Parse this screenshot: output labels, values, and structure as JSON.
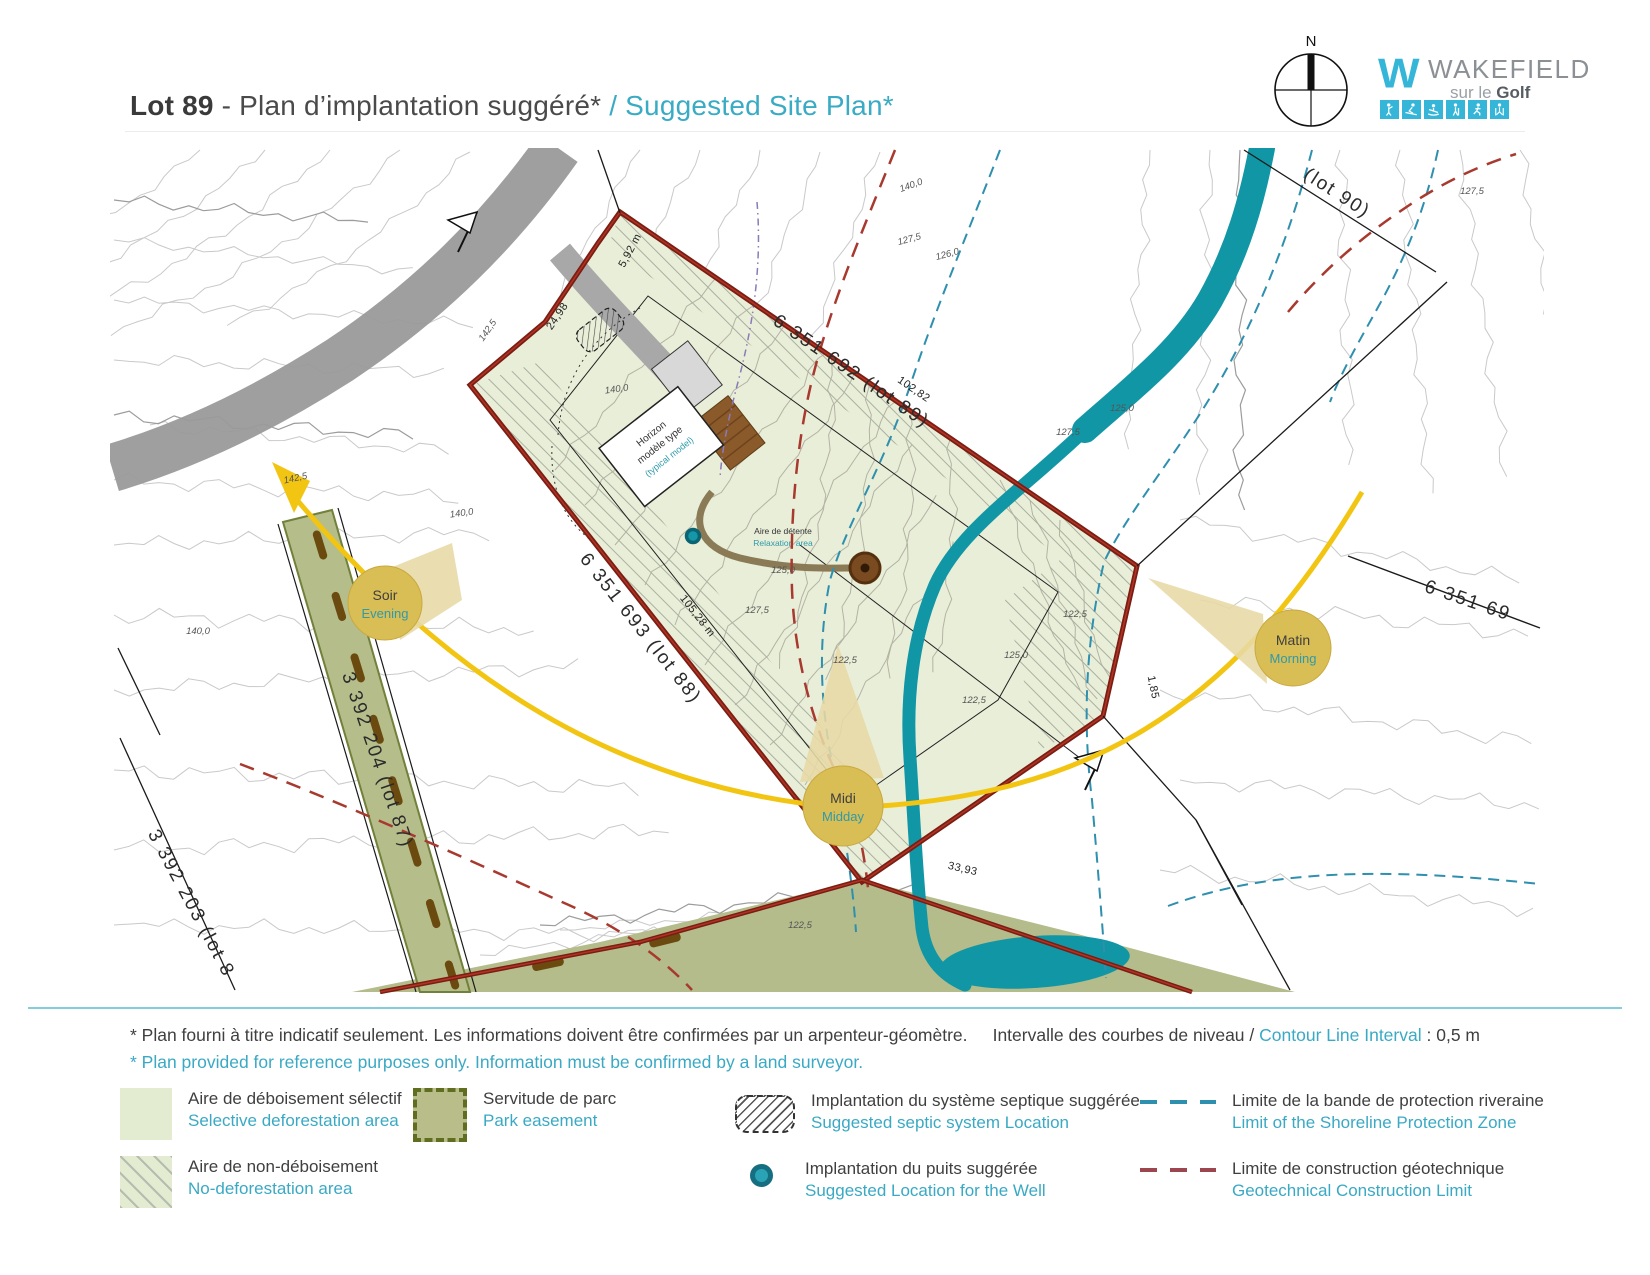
{
  "header": {
    "lot": "Lot 89",
    "title_fr": "- Plan d’implantation suggéré*",
    "title_en": "/ Suggested Site Plan*"
  },
  "compass": {
    "north": "N"
  },
  "logo": {
    "monogram": "W",
    "brand": "WAKEFIELD",
    "tagline_pre": "sur le ",
    "tagline_bold": "Golf",
    "activity_icons": [
      "golfer-icon",
      "skier-icon",
      "paddler-icon",
      "hiker-icon",
      "runner-icon",
      "xc-skier-icon"
    ]
  },
  "map": {
    "lots": {
      "lot89": "6 351 692 (lot 89)",
      "lot88": "6 351 693 (lot 88)",
      "lot87": "3 392 204 (lot 87)",
      "lot83": "3 392 203 (lot 8",
      "lot90": "(lot 90)",
      "lot_right": "6 351 69"
    },
    "measurements": {
      "m1": "5,92 m",
      "m2": "24,98",
      "m3": "102,82",
      "m4": "105,28 m",
      "m5": "1,85",
      "m6": "33,93"
    },
    "contour_labels": [
      {
        "t": "142,5"
      },
      {
        "t": "140,0"
      },
      {
        "t": "140,0"
      },
      {
        "t": "142,5"
      },
      {
        "t": "140,0"
      },
      {
        "t": "127,5"
      },
      {
        "t": "125,0"
      },
      {
        "t": "122,5"
      },
      {
        "t": "140,0"
      },
      {
        "t": "127,5"
      },
      {
        "t": "126,0"
      },
      {
        "t": "127,5"
      },
      {
        "t": "125,0"
      },
      {
        "t": "122,5"
      },
      {
        "t": "125,0"
      },
      {
        "t": "122,5"
      },
      {
        "t": "122,5"
      },
      {
        "t": "127,5"
      }
    ],
    "sun": {
      "soir_fr": "Soir",
      "soir_en": "Evening",
      "midi_fr": "Midi",
      "midi_en": "Midday",
      "matin_fr": "Matin",
      "matin_en": "Morning"
    },
    "house": {
      "line1": "Horizon",
      "line2": "modèle type",
      "line3": "(typical model)"
    },
    "relax": {
      "fr": "Aire de détente",
      "en": "Relaxation area"
    }
  },
  "footnote": {
    "fr": "* Plan fourni à titre indicatif seulement. Les informations doivent être confirmées par un arpenteur-géomètre.",
    "en": "* Plan provided for reference purposes only. Information must be confirmed by a land surveyor."
  },
  "contour_interval": {
    "fr": "Intervalle des courbes de niveau /",
    "en": "Contour Line Interval",
    "value": ": 0,5 m"
  },
  "legend": {
    "items": [
      {
        "fr": "Aire de déboisement sélectif",
        "en": "Selective deforestation area"
      },
      {
        "fr": "Aire de non-déboisement",
        "en": "No-deforestation area"
      },
      {
        "fr": "Servitude de parc",
        "en": "Park easement"
      },
      {
        "fr": "Implantation du système septique suggérée",
        "en": "Suggested septic system Location"
      },
      {
        "fr": "Implantation du puits suggérée",
        "en": "Suggested Location for the Well"
      },
      {
        "fr": "Limite de la bande de protection riveraine",
        "en": "Limit of the Shoreline Protection Zone"
      },
      {
        "fr": "Limite de construction géotechnique",
        "en": "Geotechnical Construction Limit"
      }
    ]
  },
  "colors": {
    "accent_teal": "#3aabc4",
    "logo_teal": "#35b6d9",
    "lot_fill": "#e9eed8",
    "lot_boundary": "#7a1d12",
    "stream": "#1196a6",
    "sun_arc": "#f2c513",
    "sun_marker": "#d9bd55",
    "park_green": "#b5bd8a",
    "shoreline_dash": "#2e8fae",
    "geotech_dash": "#a04a52",
    "well": "#1899a6"
  }
}
